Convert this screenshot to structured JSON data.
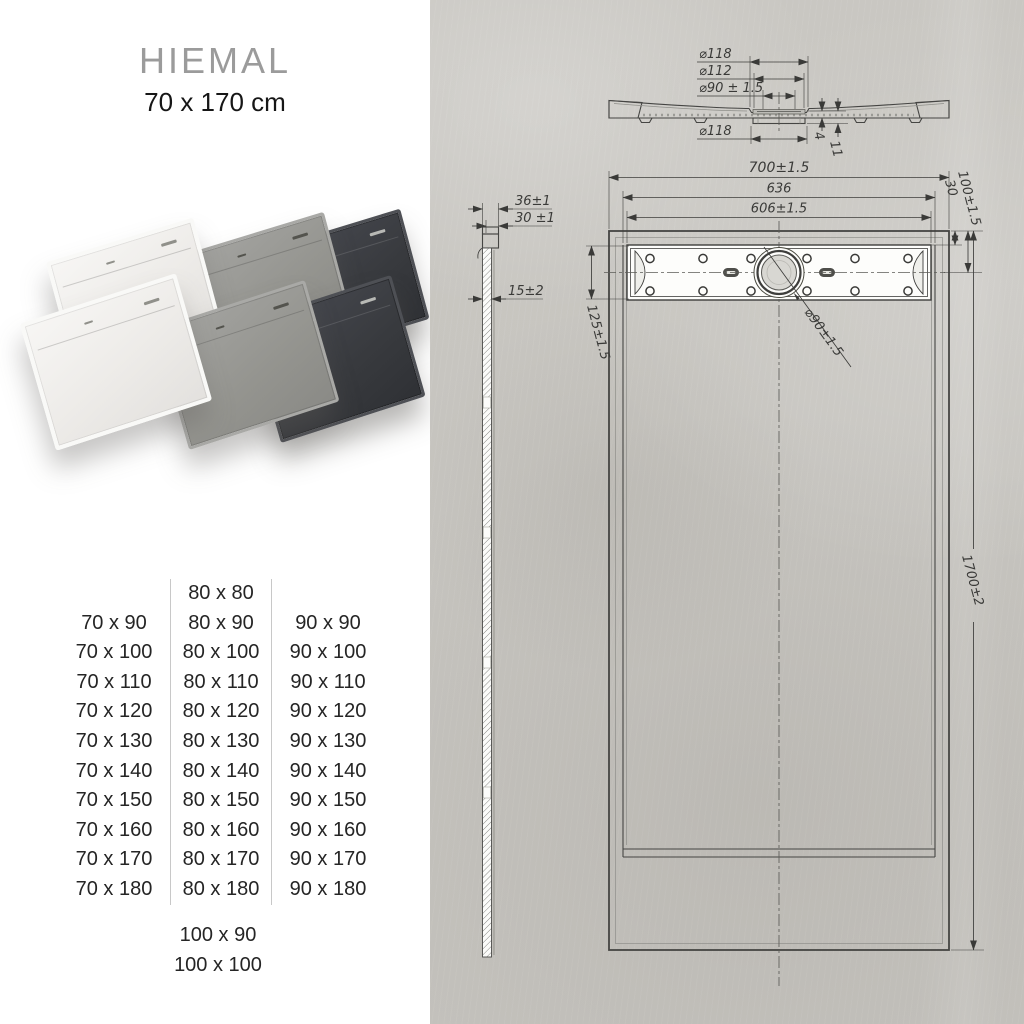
{
  "header": {
    "title": "HIEMAL",
    "subtitle": "70 x 170 cm"
  },
  "sizes": {
    "col_70": [
      "70 x 90",
      "70 x 100",
      "70 x 110",
      "70 x 120",
      "70 x 130",
      "70 x 140",
      "70 x 150",
      "70 x 160",
      "70 x 170",
      "70 x 180"
    ],
    "col_80": [
      "80 x 80",
      "80 x 90",
      "80 x 100",
      "80 x 110",
      "80 x 120",
      "80 x 130",
      "80 x 140",
      "80 x 150",
      "80 x 160",
      "80 x 170",
      "80 x 180"
    ],
    "col_90": [
      "90 x 90",
      "90 x 100",
      "90 x 110",
      "90 x 120",
      "90 x 130",
      "90 x 140",
      "90 x 150",
      "90 x 160",
      "90 x 170",
      "90 x 180"
    ],
    "extra": [
      "100 x 90",
      "100 x 100"
    ]
  },
  "trays": {
    "colors": {
      "white": "#f2f1ee",
      "gray": "#97978f",
      "anthracite": "#3a3c40"
    }
  },
  "drawing": {
    "section": {
      "dia118_top": "⌀118",
      "dia112": "⌀112",
      "dia90": "⌀90 ± 1.5",
      "dia118_bottom": "⌀118",
      "depth_4": "4",
      "depth_11": "11"
    },
    "side": {
      "height36": "36±1",
      "height30": "30 ±1",
      "height15": "15±2"
    },
    "plan": {
      "width700": "700±1.5",
      "width636": "636",
      "width606": "606±1.5",
      "edge30": "30",
      "edge100": "100±1.5",
      "channel125": "125±1.5",
      "drain90": "⌀90±1.5",
      "length1700": "1700±2"
    }
  }
}
